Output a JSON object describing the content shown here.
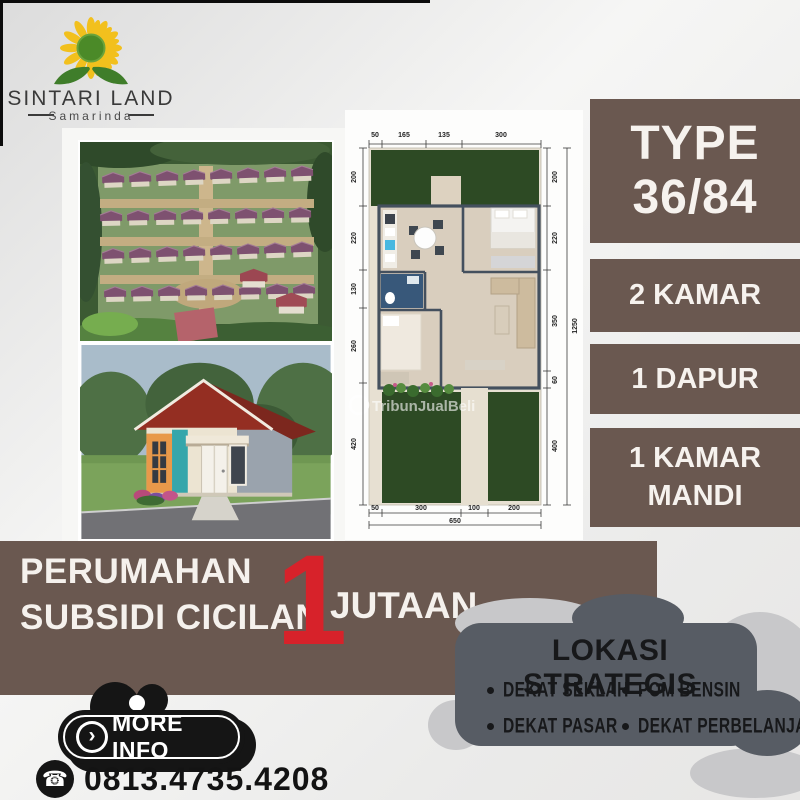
{
  "palette": {
    "brand_brown": "#6a5850",
    "accent_red": "#d7222a",
    "panel_slate": "#575c64",
    "cloud_gray": "#c8c8ca",
    "black": "#151515",
    "off_white": "#f6f2ee",
    "logo_yellow": "#f2c01d",
    "logo_green": "#4b8a28"
  },
  "logo": {
    "title": "SINTARI LAND",
    "subtitle": "Samarinda"
  },
  "type_card": {
    "line1": "TYPE",
    "line2": "36/84"
  },
  "feature_cards": [
    {
      "label": "2 KAMAR"
    },
    {
      "label": "1 DAPUR"
    },
    {
      "label": "1 KAMAR MANDI"
    }
  ],
  "banner": {
    "line1": "PERUMAHAN",
    "line2": "SUBSIDI CICILAN",
    "big_number": "1",
    "big_number_suffix": "JUTAAN"
  },
  "location": {
    "title": "LOKASI STRATEGIS",
    "col1": [
      "DEKAT SEKLAH",
      "DEKAT PASAR"
    ],
    "col2": [
      "POM BENSIN",
      "DEKAT PERBELANJAAN"
    ]
  },
  "cta": {
    "more_info_label": "MORE INFO",
    "phone": "0813.4735.4208",
    "phone_icon_glyph": "☎",
    "arrow_icon_glyph": "›"
  },
  "floor_plan": {
    "watermark": "TribunJualBeli",
    "dims_top": [
      "50",
      "165",
      "135",
      "300"
    ],
    "dims_bottom": [
      "50",
      "300",
      "100",
      "200"
    ],
    "total_width": "650",
    "dims_left": [
      "200",
      "220",
      "130",
      "260",
      "420"
    ],
    "dims_right": [
      "200",
      "220",
      "350",
      "60",
      "400"
    ],
    "total_height": "1250"
  }
}
